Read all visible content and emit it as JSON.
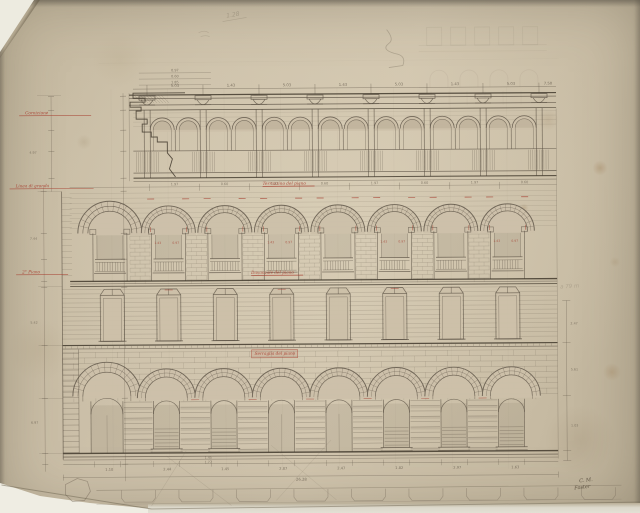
{
  "diagram_type": "architectural-elevation-drawing",
  "palette": {
    "paper": "#ccc0a9",
    "ink": "#5a5043",
    "ink_dark": "#423a2d",
    "pencil": "#7b705f",
    "red": "#a63b2c",
    "backing": "#efede3"
  },
  "inscriptions": {
    "pencil_top_note": "1.28",
    "pencil_right_note": "a 79 m",
    "signature_line1": "C. M.",
    "signature_line2": "Foster"
  },
  "red_annotations": [
    {
      "text": "Cornicione",
      "x": 26,
      "y": 114,
      "w": 66,
      "style": "line"
    },
    {
      "text": "Linea di gronda",
      "x": 16,
      "y": 187,
      "w": 78,
      "style": "line"
    },
    {
      "text": "2° Piano",
      "x": 22,
      "y": 273,
      "w": 46,
      "style": "line"
    },
    {
      "text": "Terrazzino del piano",
      "x": 263,
      "y": 186,
      "w": 52,
      "style": "underline"
    },
    {
      "text": "Davanzale del piano",
      "x": 251,
      "y": 275,
      "w": 52,
      "style": "underline"
    },
    {
      "text": "Serraglia del piano",
      "x": 254,
      "y": 356,
      "w": 40,
      "style": "boxed"
    }
  ],
  "dimension_labels": {
    "top_row": [
      "5.03",
      "1.43",
      "5.03",
      "1.43",
      "5.03",
      "1.43",
      "5.03"
    ],
    "top_right": "7.50",
    "top_left_stack": [
      "0.97",
      "0.60",
      "1.85"
    ],
    "attic_row": [
      "1.97",
      "0.60",
      "1.97",
      "0.60",
      "1.97",
      "0.60",
      "1.97",
      "0.60"
    ],
    "red_dims": [
      "1.43",
      "0.97"
    ],
    "bottom_row": [
      "1.10",
      "2.44",
      "1.45",
      "2.87",
      "2.47",
      "1.82",
      "2.97",
      "1.63"
    ],
    "bottom_stack": [
      "1.45",
      "1.77"
    ],
    "bottom_total": "26.28",
    "left_chain": [
      "4.97",
      "7.44",
      "5.42",
      "6.97"
    ],
    "right_chain": [
      "2.47",
      "5.61",
      "1.03"
    ]
  },
  "facade": {
    "left": 62,
    "right": 557,
    "entablature_y": 94,
    "attic": {
      "pier_x0": 148,
      "bay": 56,
      "piers": 8,
      "arch_r": 12,
      "spring_y": 129,
      "parapet_top": 150,
      "parapet_bot": 172,
      "base_y": 177
    },
    "arcade": {
      "cx0": 112,
      "step": 56.5,
      "count": 8,
      "r_outer": 27,
      "r_inner": 20,
      "spring_y": 232,
      "sill_y": 258,
      "balustrade_bot": 272,
      "base_y": 280
    },
    "middle": {
      "top_y": 286,
      "bot_y": 343,
      "win_half": 12,
      "win_top": 294,
      "win_bot": 340
    },
    "ground": {
      "cx0": 165.5,
      "step": 57.5,
      "count": 7,
      "portal_cx": 106,
      "r_outer": 29,
      "r_inner": 21,
      "spring_y": 397,
      "open_half": 13,
      "sill_y": 448,
      "base_y": 452,
      "door_bays": [
        2,
        3
      ]
    },
    "plan": {
      "top_y": 489,
      "bump_bot": 501,
      "x0": 95,
      "x1": 620
    }
  }
}
